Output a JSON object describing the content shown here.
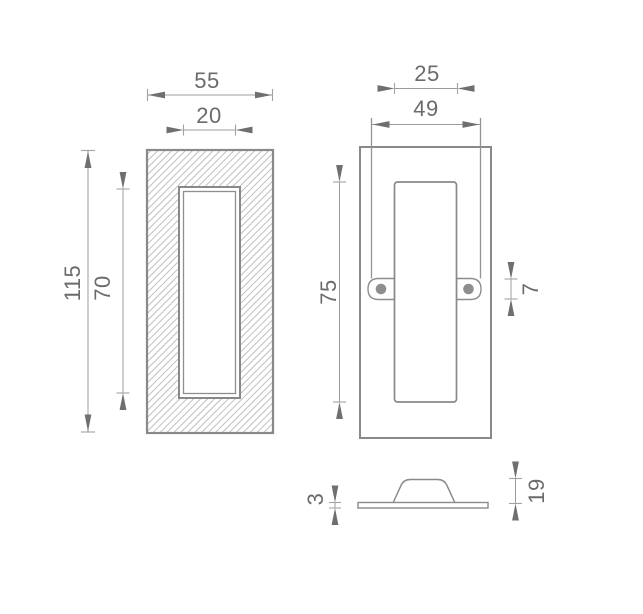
{
  "views": {
    "front_section": {
      "overall_width": "55",
      "recess_width": "20",
      "overall_height": "115",
      "recess_height": "70"
    },
    "rear": {
      "recess_opening_width": "25",
      "mounting_span": "49",
      "recess_height": "75",
      "screw_lug_height": "7"
    },
    "profile": {
      "plate_thickness": "3",
      "cup_height": "19"
    }
  },
  "colors": {
    "background": "#ffffff",
    "outline": "#898989",
    "hatch": "#b8b8b8",
    "dimension_line": "#9c9c9c",
    "arrow": "#6f6f6f",
    "label_text": "#6b6b6b",
    "screw_fill": "#8e8e8e"
  }
}
